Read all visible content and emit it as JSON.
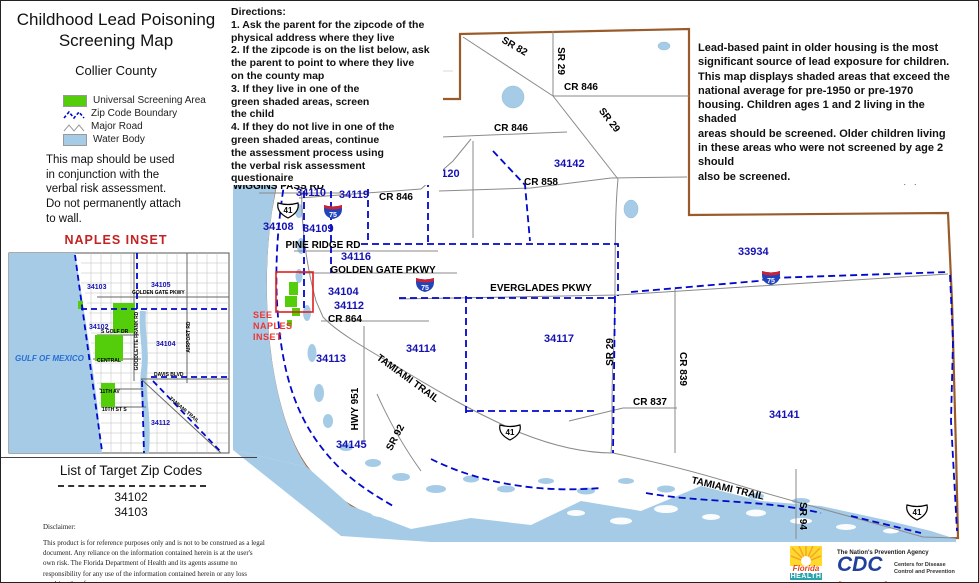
{
  "title": {
    "line1": "Childhood Lead Poisoning",
    "line2": "Screening Map",
    "subtitle": "Collier County"
  },
  "legend": {
    "items": [
      "Universal Screening Area",
      "Zip Code Boundary",
      "Major Road",
      "Water Body"
    ]
  },
  "usage_note": "This map should be used\nin conjunction with the\nverbal risk assessment.\nDo not permanently attach\nto wall.",
  "naples_inset_heading": "NAPLES  INSET",
  "directions": "Directions:\n1. Ask the parent for the zipcode of the\nphysical address where they live\n2. If the zipcode is on the list below, ask\nthe parent to point to where they live\non the county map\n3.  If they live in one of the\ngreen shaded areas, screen\nthe child\n4.  If they do not live in one of the\ngreen shaded areas, continue\nthe assessment process using\nthe verbal risk assessment\nquestionaire",
  "info_text": "Lead-based paint in older housing is the most\nsignificant source of lead exposure for children.\nThis map displays shaded areas that exceed the\nnational average for pre-1950 or pre-1970\nhousing.  Children ages 1 and 2 living in the shaded\nareas should be screened.  Older children living\nin these areas who were not screened by age 2 should\nalso be screened.",
  "target_zips": {
    "title": "List of Target Zip Codes",
    "codes": "34102\n34103"
  },
  "disclaimer": {
    "heading": "Disclaimer:",
    "body": "This product is for reference purposes only and is not to be construed as a legal document. Any reliance on the information contained herein is at the user's own risk. The Florida Department of Health and its agents assume no responsibility for any use of the information contained herein or any loss resulting therefrom."
  },
  "scale_bar": {
    "t0": "0",
    "t1": "4",
    "t2": "8",
    "unit": "Miles"
  },
  "north_label": "N",
  "main": {
    "zips": [
      "34120",
      "34142",
      "34110",
      "34119",
      "34108",
      "34109",
      "34116",
      "34104",
      "34112",
      "34113",
      "34114",
      "34117",
      "34145",
      "33934",
      "34141"
    ],
    "roads": [
      "SR 82",
      "SR 29",
      "CR 846",
      "SR 29",
      "CR 846",
      "CR 858",
      "WIGGINS PASS RD",
      "CR 846",
      "PINE RIDGE RD",
      "GOLDEN GATE PKWY",
      "EVERGLADES PKWY",
      "CR 864",
      "TAMIAMI TRAIL",
      "HWY 951",
      "SR 92",
      "SR 29",
      "CR 839",
      "CR 837",
      "TAMIAMI TRAIL",
      "SR 94"
    ],
    "shield_us": "41",
    "shield_i75": "75",
    "see_inset": [
      "SEE",
      "NAPLES",
      "INSET"
    ]
  },
  "inset": {
    "zips": [
      "34103",
      "34105",
      "34102",
      "34104",
      "34112"
    ],
    "roads": [
      "GOLDEN GATE PKWY",
      "S GOLF DR",
      "CENTRAL",
      "DAVIS BLVD",
      "11TH AV",
      "10TH ST S",
      "TAMIAMI TRAIL",
      "AIRPORT RD",
      "GOODLETTE FRANK RD"
    ],
    "gulf_label": "GULF OF MEXICO"
  },
  "logos": {
    "florida": {
      "name": "Florida",
      "dept": "HEALTH"
    },
    "cdc": {
      "tagline": "The Nation's Prevention Agency",
      "name": "CDC",
      "cap1": "Centers for Disease",
      "cap2": "Control and Prevention"
    }
  },
  "colors": {
    "screening_green": "#54CE0A",
    "water_blue": "#A5CBE6",
    "zip_boundary_blue": "#0000CC",
    "county_brown": "#9A5B2B",
    "inset_red": "#EE3333"
  }
}
